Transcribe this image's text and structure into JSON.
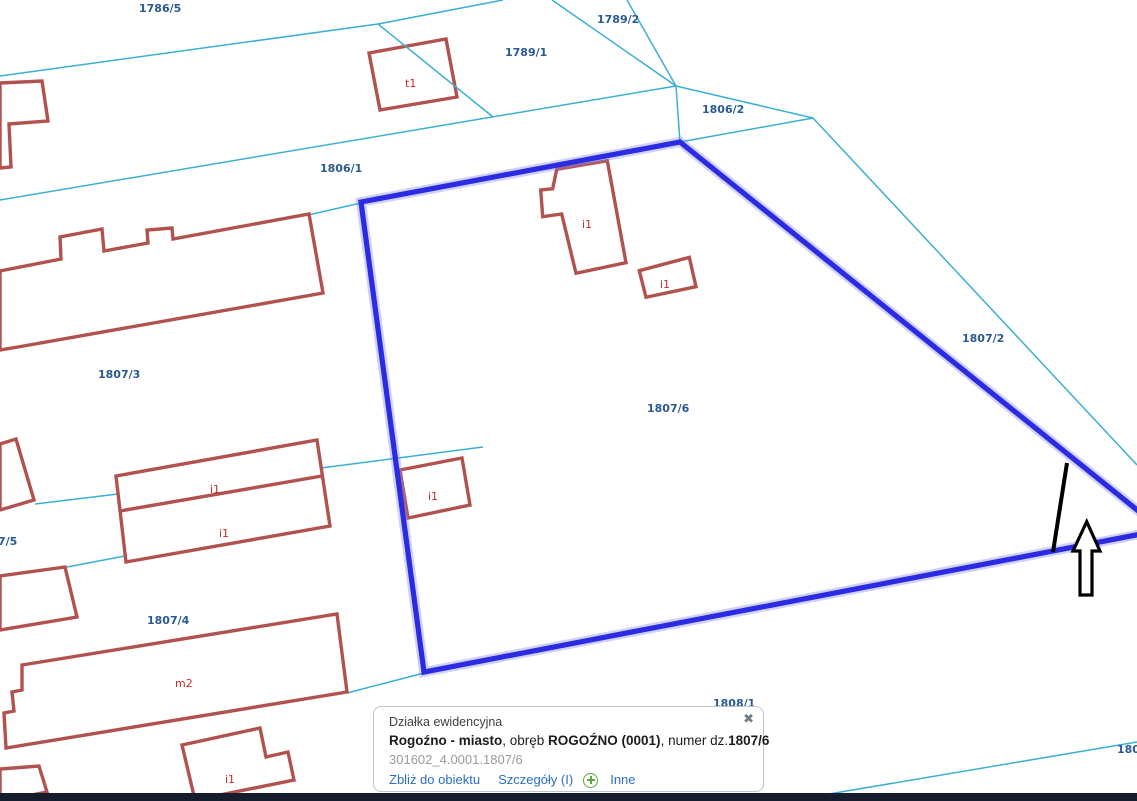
{
  "window": {
    "width": 1137,
    "height": 801
  },
  "colors": {
    "boundary": "#3cafd1",
    "highlight": "#2b2be2",
    "highlight_glow": "#8585f2",
    "building": "#b2524e",
    "building_label": "#c92a2a",
    "parcel_label": "#2a5a91",
    "link": "#2b6fc2",
    "plus_green": "#5ba839",
    "popup_border": "#bfc3cf",
    "bottom_bar": "#141c2e",
    "annotation": "#000000"
  },
  "map": {
    "highlighted_parcel": "1807/6",
    "parcel_labels": [
      {
        "text": "1786/5",
        "x": 139,
        "y": 12
      },
      {
        "text": "1789/2",
        "x": 597,
        "y": 23
      },
      {
        "text": "1789/1",
        "x": 505,
        "y": 56
      },
      {
        "text": "1806/2",
        "x": 702,
        "y": 113
      },
      {
        "text": "1806/1",
        "x": 320,
        "y": 172
      },
      {
        "text": "1807/2",
        "x": 962,
        "y": 342
      },
      {
        "text": "1807/3",
        "x": 98,
        "y": 378
      },
      {
        "text": "1807/6",
        "x": 647,
        "y": 412
      },
      {
        "text": "7/5",
        "x": -2,
        "y": 545
      },
      {
        "text": "1807/4",
        "x": 147,
        "y": 624
      },
      {
        "text": "1808/1",
        "x": 713,
        "y": 707
      },
      {
        "text": "180",
        "x": 1117,
        "y": 753
      }
    ],
    "building_labels": [
      {
        "text": "t1",
        "x": 405,
        "y": 87
      },
      {
        "text": "i1",
        "x": 582,
        "y": 228
      },
      {
        "text": "i1",
        "x": 660,
        "y": 288
      },
      {
        "text": "i1",
        "x": 210,
        "y": 493
      },
      {
        "text": "i1",
        "x": 219,
        "y": 537
      },
      {
        "text": "i1",
        "x": 428,
        "y": 500
      },
      {
        "text": "m2",
        "x": 175,
        "y": 687
      },
      {
        "text": "i1",
        "x": 225,
        "y": 783
      }
    ]
  },
  "popup": {
    "title": "Działka ewidencyjna",
    "line2": {
      "bold1": "Rogoźno - miasto",
      "sep1": ", obręb ",
      "bold2": "ROGOŹNO (0001)",
      "sep2": ", numer dz.",
      "bold3": "1807/6"
    },
    "identifier": "301602_4.0001.1807/6",
    "links": {
      "zoom_to": "Zbliż do obiektu",
      "details": "Szczegóły (I)",
      "more": "Inne"
    },
    "close_glyph": "✖"
  }
}
